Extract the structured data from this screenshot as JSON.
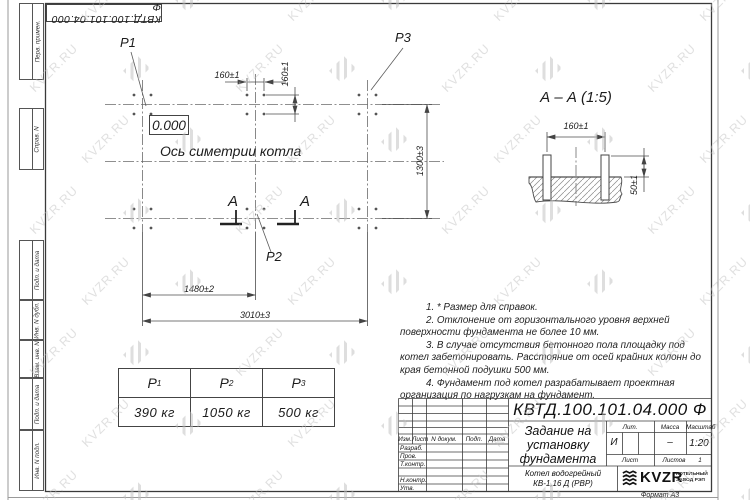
{
  "page": {
    "format_label": "Формат А3"
  },
  "watermark": {
    "text": "KVZR.RU"
  },
  "top_stamp": {
    "designation": "КВТД.100.101.04.000  Ф"
  },
  "margin_labels": {
    "perv": "Перв. примен.",
    "sprav": "Справ. N",
    "podp1": "Подп. и дата",
    "inv_dubl": "Инв. N дубл.",
    "vzam": "Взам. инв. N",
    "podp2": "Подп. и дата",
    "inv_podl": "Инв. N подл."
  },
  "plan": {
    "level_mark": "0.000",
    "symmetry_axis_label": "Ось симетрии котла",
    "p1": "Р1",
    "p2": "Р2",
    "p3": "Р3",
    "dim_top_160": "160±1",
    "dim_side_160": "160±1",
    "dim_1300": "1300±3",
    "dim_1480": "1480±2",
    "dim_3010": "3010±3",
    "section_mark_left": "А",
    "section_mark_right": "А"
  },
  "section_view": {
    "title": "А – А  (1:5)",
    "dim_160": "160±1",
    "dim_50": "50±1"
  },
  "notes": [
    "1. * Размер для справок.",
    "2. Отклонение от горизонтального уровня верхней поверхности фундамента не более 10 мм.",
    "3. В случае отсутствия бетонного пола площадку под котел забетонировать. Расстояние от осей крайних колонн до края бетонной подушки 500 мм.",
    "4. Фундамент под котел разрабатывает проектная организация по нагрузкам на фундамент."
  ],
  "load_table": {
    "columns": [
      {
        "sym": "Р",
        "sub": "1",
        "value": "390 кг"
      },
      {
        "sym": "Р",
        "sub": "2",
        "value": "1050 кг"
      },
      {
        "sym": "Р",
        "sub": "3",
        "value": "500 кг"
      }
    ]
  },
  "title_block": {
    "designation": "КВТД.100.101.04.000  Ф",
    "doc_title_lines": [
      "Задание на",
      "установку",
      "фундамента"
    ],
    "product_lines": [
      "Котел водогрейный",
      "КВ-1,16 Д (РВР)"
    ],
    "columns": {
      "izm": "Изм.",
      "list": "Лист",
      "doc": "N докум.",
      "podp": "Подп.",
      "data": "Дата"
    },
    "rows": {
      "razrab": "Разраб.",
      "prov": "Пров.",
      "tkontr": "Т.контр.",
      "nkontr": "Н.контр.",
      "utv": "Утв."
    },
    "lit": {
      "header": "Лит.",
      "value": "И"
    },
    "mass": {
      "header": "Масса",
      "value": "–"
    },
    "scale": {
      "header": "Масштаб",
      "value": "1:20"
    },
    "sheet": {
      "list_label": "Лист",
      "listov_label": "Листов",
      "listov_value": "1"
    },
    "company": {
      "brand": "KVZR",
      "line1": "КОТЕЛЬНЫЙ",
      "line2": "ЗАВОД РЭП"
    }
  }
}
